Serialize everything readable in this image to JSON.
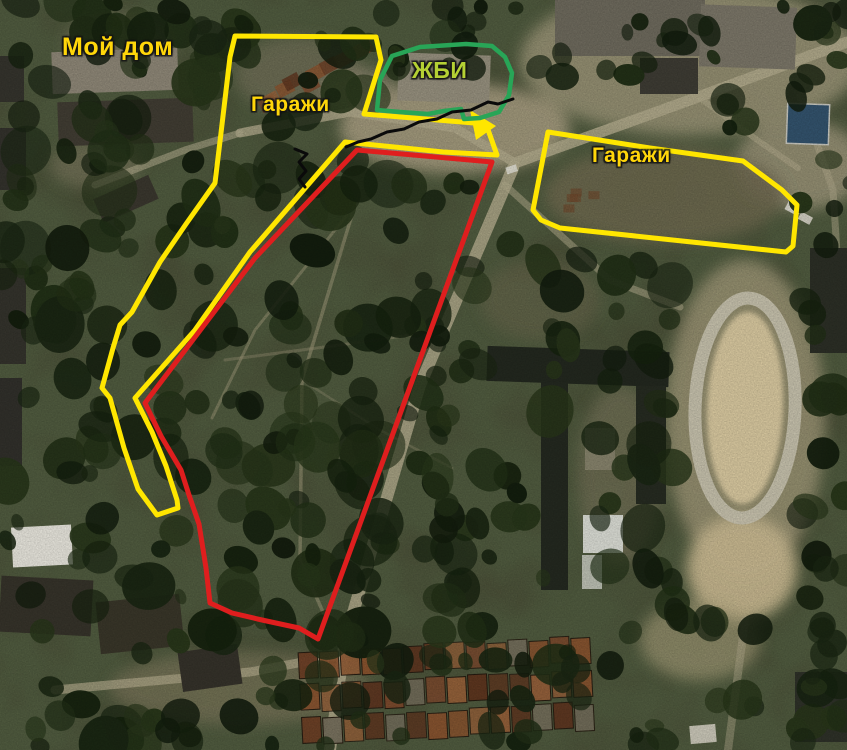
{
  "map": {
    "width": 847,
    "height": 750,
    "type": "annotated-satellite-image",
    "labels": [
      {
        "id": "my-house",
        "text": "Мой дом",
        "x": 62,
        "y": 35,
        "size": 25,
        "color": "#ffd60a"
      },
      {
        "id": "garages-left",
        "text": "Гаражи",
        "x": 251,
        "y": 94,
        "size": 21,
        "color": "#ffd60a"
      },
      {
        "id": "zhbi",
        "text": "ЖБИ",
        "x": 412,
        "y": 59,
        "size": 23,
        "color": "#b5d034"
      },
      {
        "id": "garages-right",
        "text": "Гаражи",
        "x": 592,
        "y": 145,
        "size": 21,
        "color": "#ffd60a"
      }
    ],
    "colors": {
      "yellow_outline": "#ffe600",
      "red_outline": "#df1e1e",
      "green_outline": "#28a557",
      "black_line": "#0a0a0a"
    },
    "annotations": [
      {
        "id": "yellow-area-garages-and-strip",
        "kind": "polygon",
        "color": "#ffe600",
        "width": 5,
        "points": "235,36 376,37 381,60 364,114 486,124 497,155 443,152 345,142 250,252 195,330 135,398 152,432 166,466 177,500 178,508 157,515 138,489 124,448 110,398 102,388 113,348 120,325 132,312 160,262 186,224 215,183 221,133 230,57"
      },
      {
        "id": "yellow-arrowhead",
        "kind": "filled",
        "color": "#ffe600",
        "points": "496,126 470,110 476,140"
      },
      {
        "id": "yellow-area-garages-right",
        "kind": "polygon",
        "color": "#ffe600",
        "width": 5,
        "points": "548,132 650,148 743,161 782,190 797,205 793,246 786,252 560,228 541,220 533,210"
      },
      {
        "id": "green-area-zhbi",
        "kind": "polygon",
        "color": "#28a557",
        "width": 4.5,
        "points": "377,110 380,80 392,56 420,47 466,44 492,46 505,57 512,73 509,95 499,112 480,118 464,119 461,109 444,111 428,114 400,112"
      },
      {
        "id": "red-area-main",
        "kind": "polygon",
        "color": "#df1e1e",
        "width": 5,
        "points": "357,150 492,162 318,639 299,628 262,620 232,613 210,603 206,568 199,524 189,495 181,470 161,436 145,403 255,258"
      },
      {
        "id": "black-path-line",
        "kind": "polyline",
        "color": "#0a0a0a",
        "width": 3,
        "points": "513,99 498,104 488,102 471,110 452,112 437,119 419,122 404,129 387,132 371,139 358,142 346,147"
      },
      {
        "id": "black-entrance-mark",
        "kind": "polyline",
        "color": "#0a0a0a",
        "width": 3,
        "points": "295,149 307,154 299,162 306,171 299,179 305,187"
      }
    ]
  }
}
